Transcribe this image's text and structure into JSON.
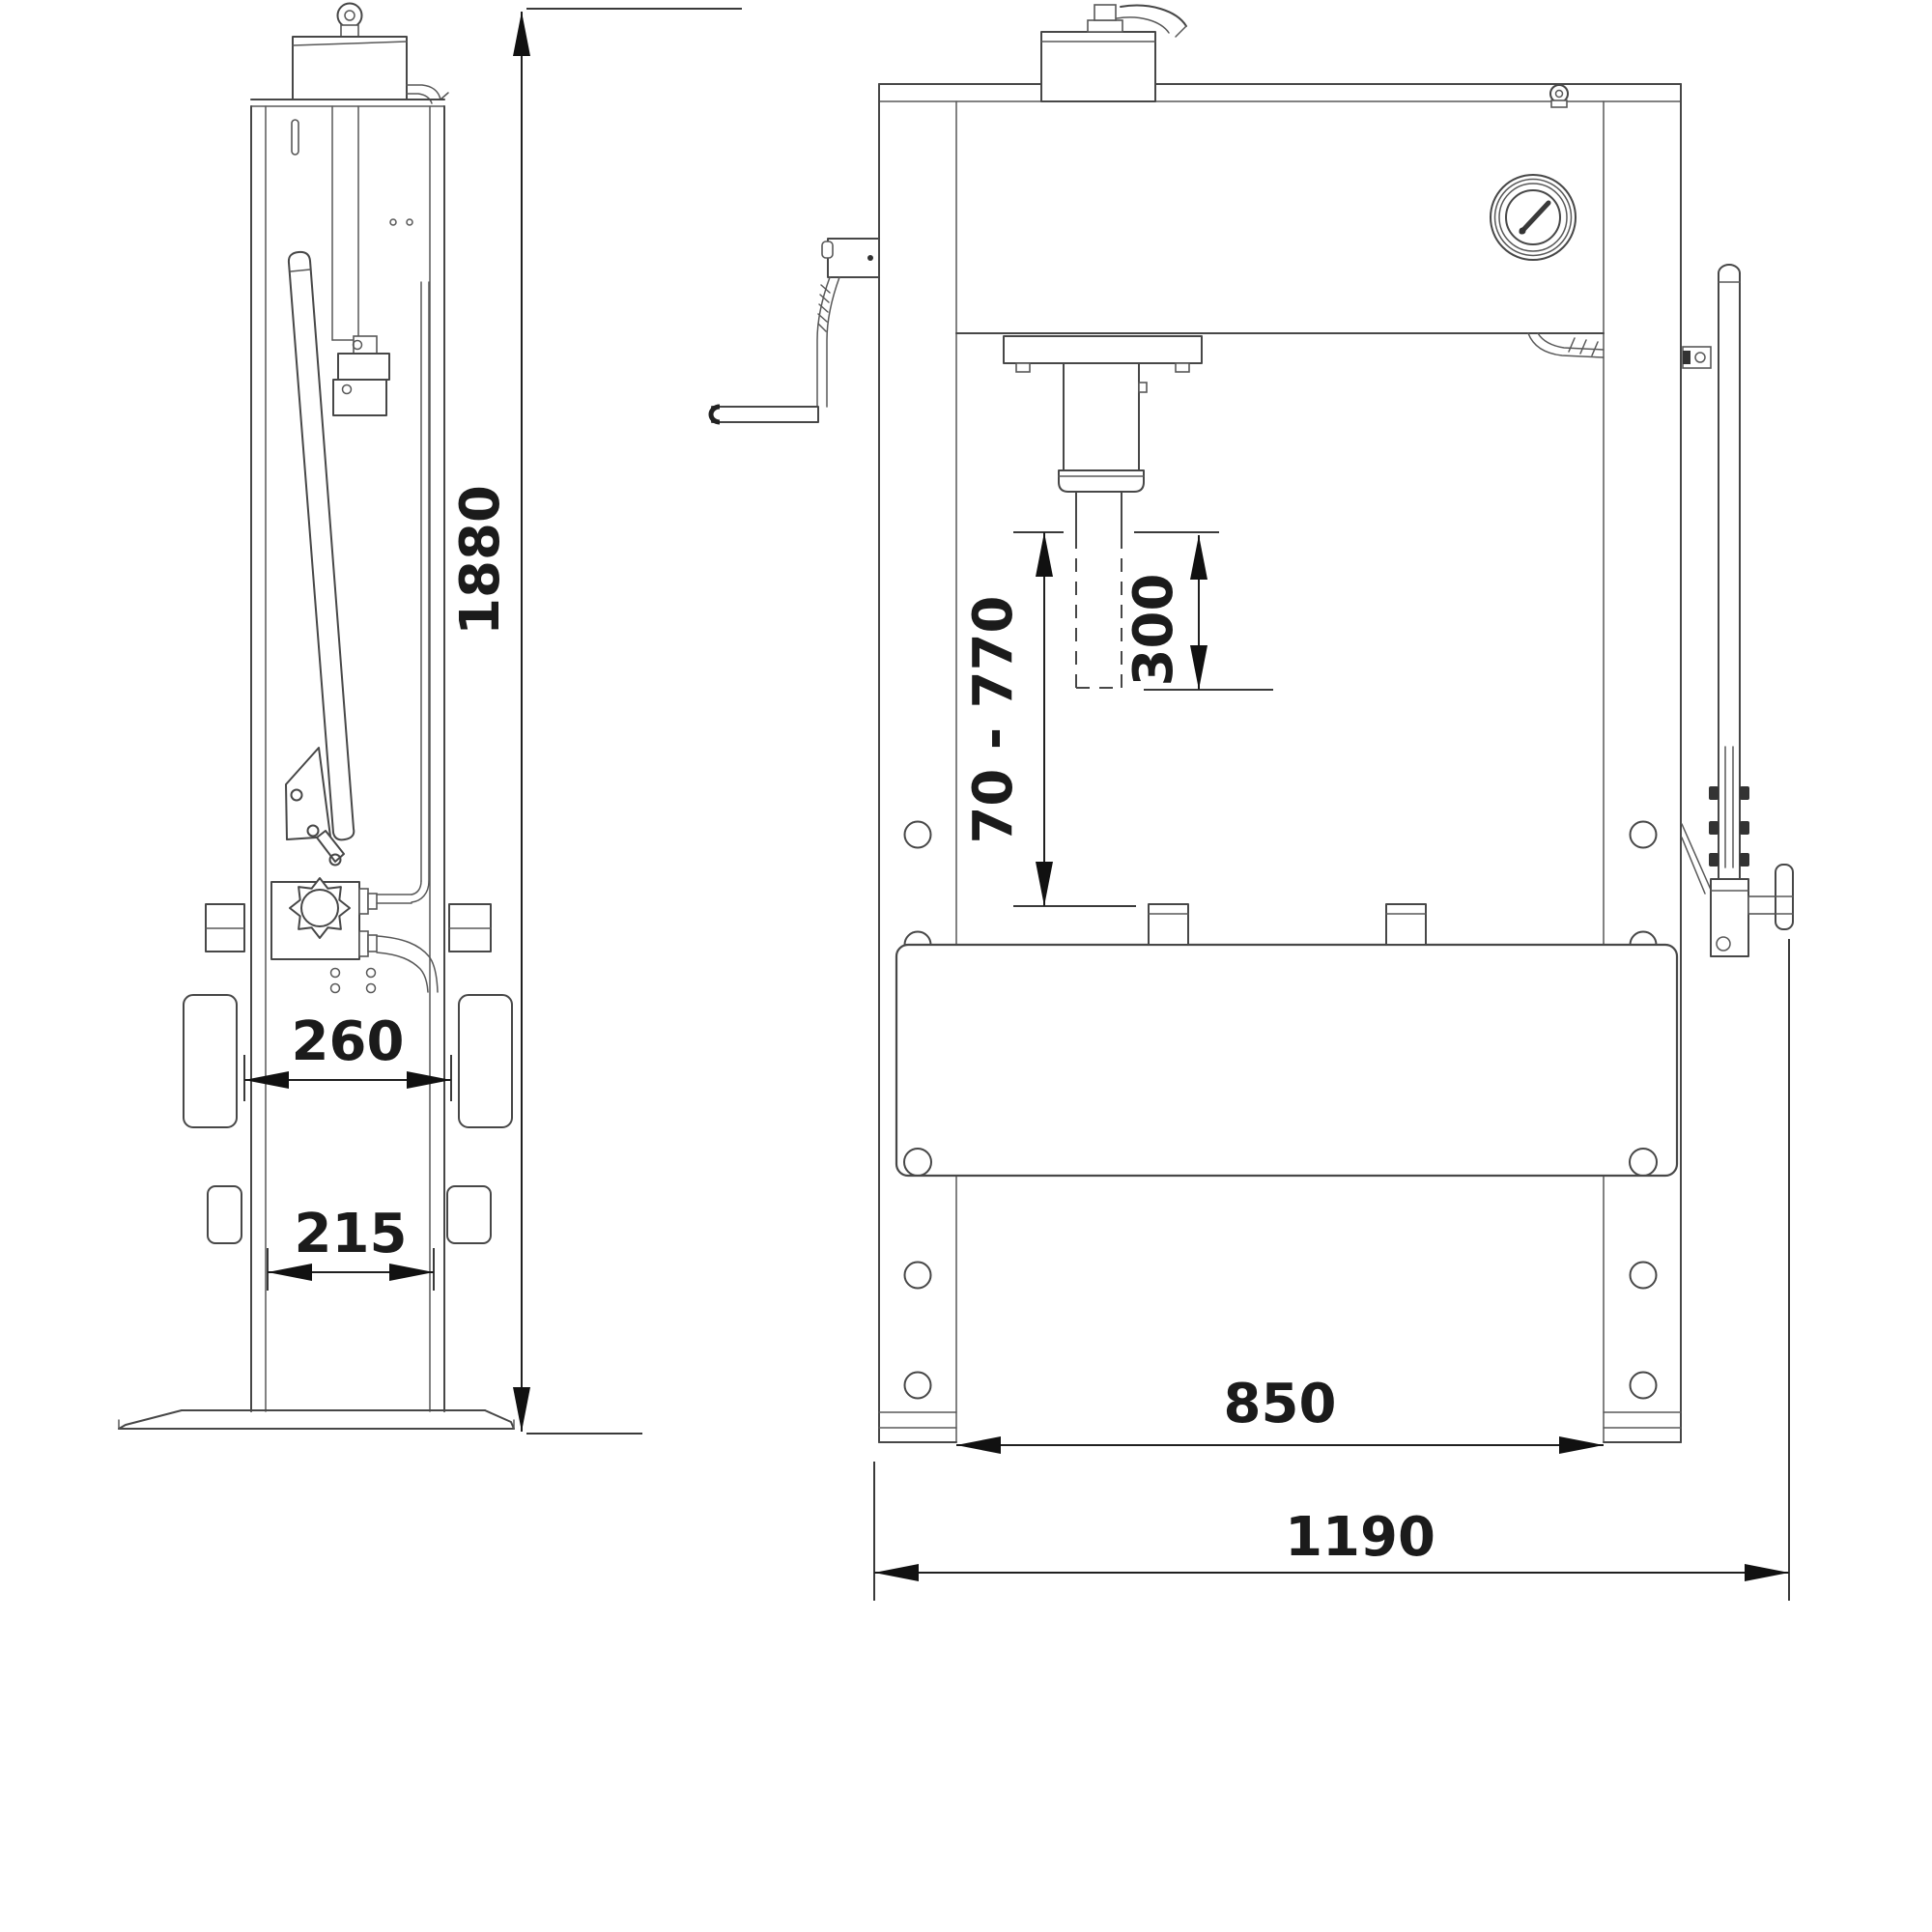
{
  "drawing": {
    "type": "technical-dimension-drawing",
    "subject": "hydraulic workshop press, side view and front view",
    "colors": {
      "line": "#474747",
      "dimension": "#1b1b1b",
      "background": "#ffffff"
    },
    "dimensions": {
      "overall_height": "1880",
      "table_plate_spacing": "260",
      "column_depth": "215",
      "working_range": "70 - 770",
      "ram_stroke": "300",
      "inner_width": "850",
      "overall_width": "1190"
    }
  }
}
